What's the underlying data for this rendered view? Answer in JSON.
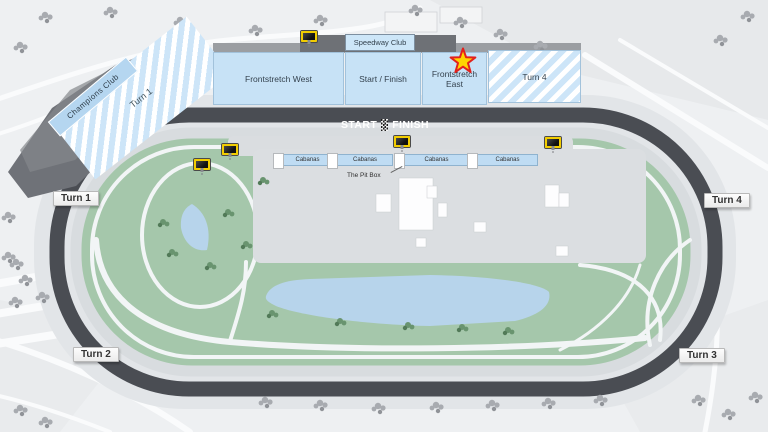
{
  "grandstands": {
    "champions_club": "Champions Club",
    "turn1": "Turn 1",
    "frontstretch_west": "Frontstretch West",
    "speedway_club": "Speedway Club",
    "start_finish": "Start / Finish",
    "frontstretch_east": "Frontstretch East",
    "turn4": "Turn 4"
  },
  "track_banner": {
    "start": "START",
    "finish": "FINISH"
  },
  "turn_markers": {
    "turn1": "Turn 1",
    "turn2": "Turn 2",
    "turn3": "Turn 3",
    "turn4": "Turn 4"
  },
  "infield": {
    "cabana_labels": [
      "Cabanas",
      "Cabanas",
      "Cabanas",
      "Cabanas"
    ],
    "pit_box_label": "The Pit Box"
  },
  "icons": {
    "video_board": "video-board-icon",
    "selected_star": "star-icon",
    "checkered_flag": "checkered-flag-icon"
  },
  "colors": {
    "grandstand_blue": "#c7e2f6",
    "stripe_blue": "#cde5f8",
    "champions_blue": "#b5d6f0",
    "track_dark": "#4a4d53",
    "infield_green": "#a5c7ab",
    "lake_blue": "#b7d4eb",
    "paddock_gray": "#dbdee1",
    "screen_yellow": "#f2cd00",
    "star_fill": "#ffd400",
    "star_border": "#e2211c"
  }
}
